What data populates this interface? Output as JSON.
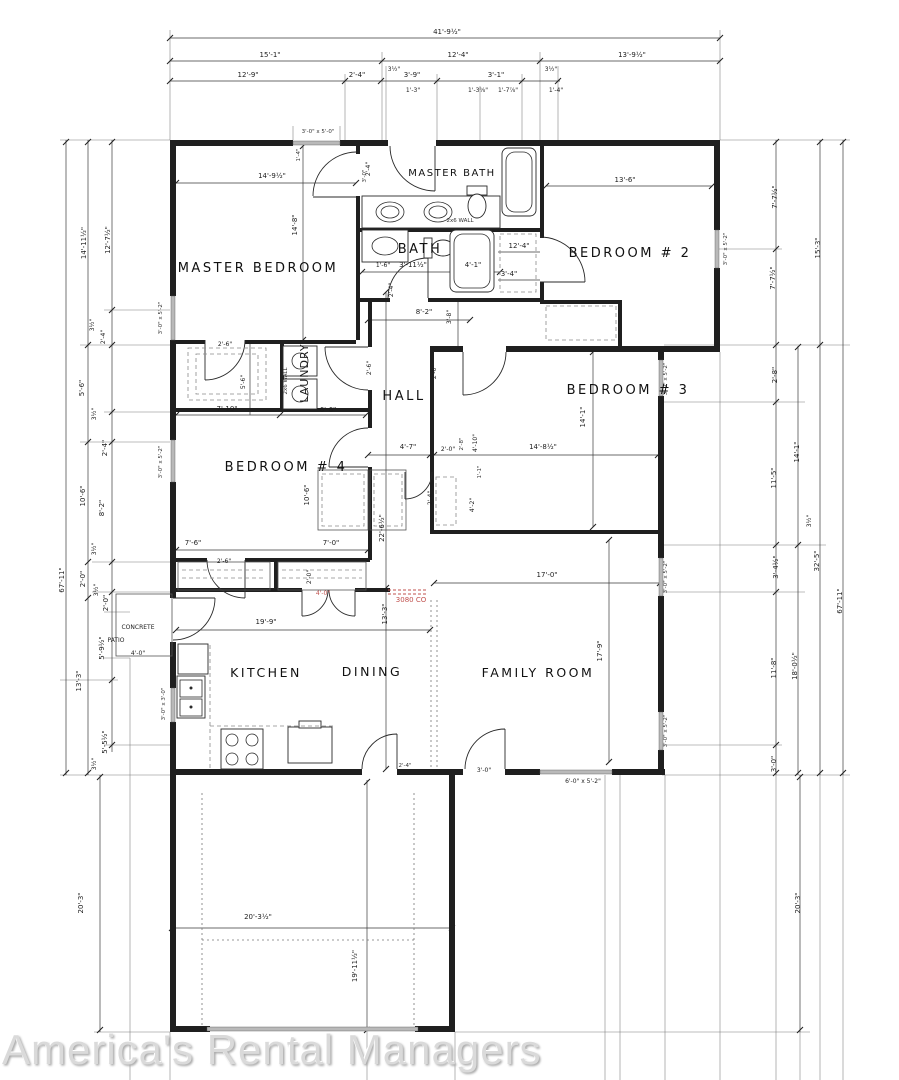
{
  "watermark": "America's Rental Managers",
  "colors": {
    "red_annotation": "#c0504d",
    "line": "#1f1f1f",
    "window_gray": "#b9b9b9",
    "watermark_gray": "#dadada"
  },
  "rooms": {
    "master_bedroom": "MASTER BEDROOM",
    "master_bath": "MASTER BATH",
    "bath": "BATH",
    "bedroom2": "BEDROOM # 2",
    "bedroom3": "BEDROOM # 3",
    "bedroom4": "BEDROOM # 4",
    "hall": "HALL",
    "laundry": "LAUNDRY",
    "kitchen": "KITCHEN",
    "dining": "DINING",
    "family_room": "FAMILY ROOM",
    "concrete": "CONCRETE",
    "patio": "PATIO",
    "patio_dim": "4'-0\"",
    "wall_a": "2x6 WALL",
    "wall_b": "2x6 WALL"
  },
  "red": {
    "door": "4'-0\"",
    "co": "3080 CO"
  },
  "windows": [
    "3'-0\" x 5'-0\"",
    "3'-0\" x 5'-2\"",
    "3'-0\" x 5'-2\"",
    "3'-0\" x 3'-0\"",
    "3'-0\" x 5'-2\"",
    "3'-0\" x 5'-2\"",
    "3'-0\" x 5'-2\"",
    "3'-0\" x 5'-2\"",
    "6'-0\" x 5'-2\""
  ],
  "dims": {
    "top": [
      "41'-9½\"",
      "15'-1\"",
      "12'-4\"",
      "13'-9½\"",
      "12'-9\"",
      "2'-4\"",
      "3½\"",
      "3'-9\"",
      "1'-3\"",
      "1'-3⅝\"",
      "1'-7⅞\"",
      "3'-1\"",
      "3½\"",
      "1'-4\""
    ],
    "left": [
      "67'-11\"",
      "14'-11½\"",
      "12'-7½\"",
      "3½\"",
      "2'-4\"",
      "5'-6\"",
      "3½\"",
      "2'-4\"",
      "10'-6\"",
      "8'-2\"",
      "3½\"",
      "2'-0\"",
      "3½\"",
      "2'-0\"",
      "5'-9½\"",
      "13'-3\"",
      "5'-5½\"",
      "3½\"",
      "20'-3\""
    ],
    "right": [
      "7'-7½\"",
      "15'-3\"",
      "7'-7½\"",
      "2'-8\"",
      "14'-1\"",
      "11'-5\"",
      "3½\"",
      "3'-4½\"",
      "32'-5\"",
      "67'-11\"",
      "11'-8\"",
      "18'-0½\"",
      "3'-0\"",
      "20'-3\""
    ],
    "i": [
      "14'-9½\"",
      "14'-8\"",
      "2'-4\"",
      "1'-4\"",
      "3'-0\"",
      "1'-6\"",
      "3'-11½\"",
      "4'-1\"",
      "12'-4\"",
      "3'-4\"",
      "2'-4\"",
      "8'-2\"",
      "3'-8\"",
      "13'-6\"",
      "2'-6\"",
      "2'-6\"",
      "2'-6\"",
      "5'-6\"",
      "7'-10\"",
      "6'-6\"",
      "14'-1\"",
      "14'-8½\"",
      "4'-7\"",
      "2'-0\"",
      "4'-10\"",
      "2'-8\"",
      "1'-1\"",
      "2'-4\"",
      "4'-2\"",
      "10'-6\"",
      "22'-6½\"",
      "7'-6\"",
      "7'-0\"",
      "2'-6\"",
      "2'-0\"",
      "19'-9\"",
      "13'-3\"",
      "17'-0\"",
      "17'-9\"",
      "3'-0\"",
      "2'-4\"",
      "20'-3½\"",
      "19'-11½\""
    ]
  }
}
